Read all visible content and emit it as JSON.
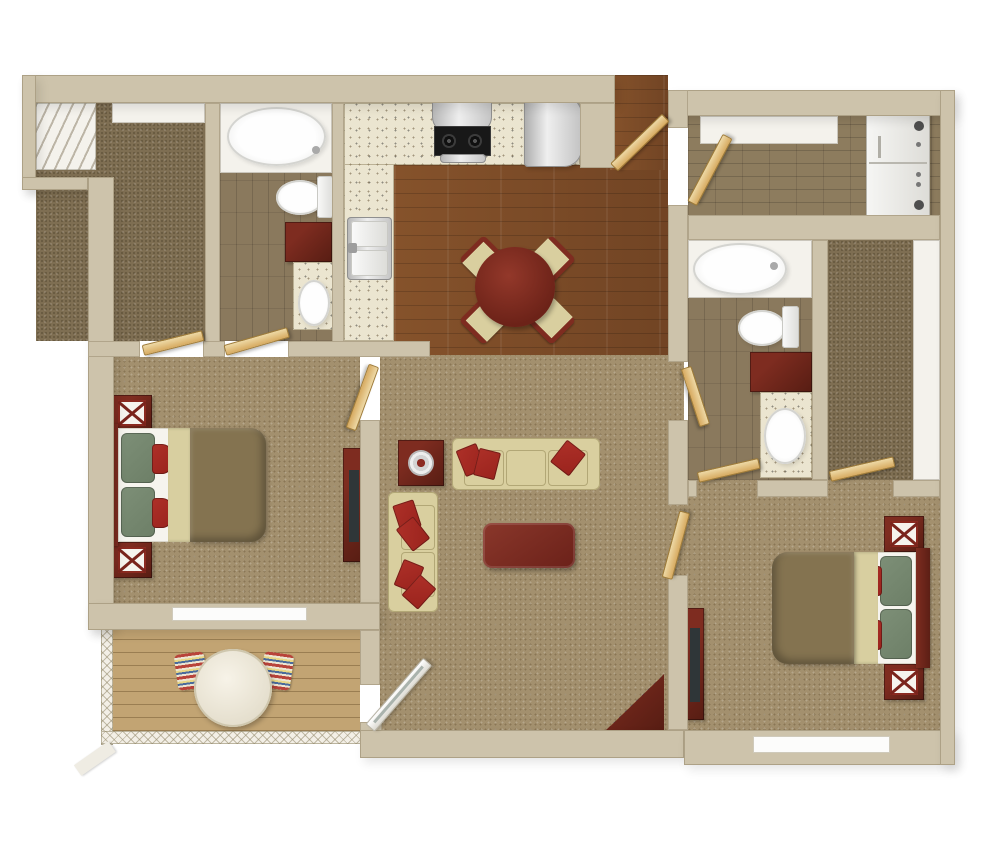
{
  "scene": {
    "type": "3d-rendered apartment floor plan, top-down view",
    "description": "Two-bedroom two-bathroom apartment with open kitchen/dining, living room, laundry room, two walk-in closets and a railed patio"
  },
  "palette": {
    "bg": "#ffffff",
    "wall": "#cdc3ab",
    "carpet": "#a3906e",
    "carpet-dark": "#7e6e52",
    "wood": "#7b4a27",
    "tile": "#8a795d",
    "brick": "#8d7c5e",
    "counter": "#ebe5d0",
    "deck": "#c2a473",
    "white-fixture": "#f4f2ec",
    "mahogany": "#7e2c20",
    "mahogany-dark": "#571d13",
    "cream-sofa": "#d9cf9f",
    "cream-sofa-edge": "#b2a776",
    "pillow-red": "#9a231d",
    "pillow-green": "#6d7f67",
    "comforter": "#847350",
    "blanket": "#d8cfa0",
    "sheet": "#f6f4ee",
    "door-tan": "#d7aa60",
    "door-tan-light": "#eed9a6",
    "tv": "#2f3638",
    "steel": "#c8c8c8"
  },
  "rooms": [
    {
      "id": "closet-1",
      "label": "Walk-in closet",
      "floor": "dark carpet",
      "features": [
        "white shelving"
      ]
    },
    {
      "id": "bathroom-1",
      "label": "Bathroom 1",
      "floor": "tile",
      "fixtures": [
        "bathtub",
        "toilet",
        "vanity with sink"
      ]
    },
    {
      "id": "kitchen",
      "label": "Kitchen",
      "floor": "hardwood",
      "fixtures": [
        "L-shaped speckled counter",
        "range with hood",
        "refrigerator",
        "double sink"
      ]
    },
    {
      "id": "dining",
      "label": "Dining area",
      "floor": "hardwood",
      "furniture": [
        "round table",
        "four chairs"
      ]
    },
    {
      "id": "entry",
      "label": "Entry",
      "floor": "hardwood",
      "features": [
        "open entry door"
      ]
    },
    {
      "id": "laundry",
      "label": "Laundry room",
      "floor": "brick tile",
      "fixtures": [
        "stacked washer-dryer",
        "wall shelf"
      ]
    },
    {
      "id": "bathroom-2",
      "label": "Bathroom 2",
      "floor": "tile",
      "fixtures": [
        "bathtub",
        "toilet",
        "vanity with sink"
      ]
    },
    {
      "id": "closet-2",
      "label": "Walk-in closet",
      "floor": "dark carpet",
      "features": [
        "white shelving"
      ]
    },
    {
      "id": "bedroom-1",
      "label": "Bedroom 1",
      "floor": "carpet",
      "furniture": [
        "bed",
        "two nightstands",
        "dresser with TV"
      ],
      "features": [
        "window"
      ]
    },
    {
      "id": "living",
      "label": "Living room",
      "floor": "carpet",
      "furniture": [
        "sofa",
        "loveseat",
        "end table with plate",
        "coffee table",
        "corner desk"
      ]
    },
    {
      "id": "bedroom-2",
      "label": "Bedroom 2",
      "floor": "carpet",
      "furniture": [
        "bed",
        "two nightstands",
        "dresser with TV"
      ],
      "features": [
        "window"
      ]
    },
    {
      "id": "patio",
      "label": "Patio",
      "floor": "wood deck",
      "furniture": [
        "round table",
        "two striped chairs"
      ],
      "features": [
        "lattice railing",
        "sliding glass door"
      ]
    }
  ]
}
